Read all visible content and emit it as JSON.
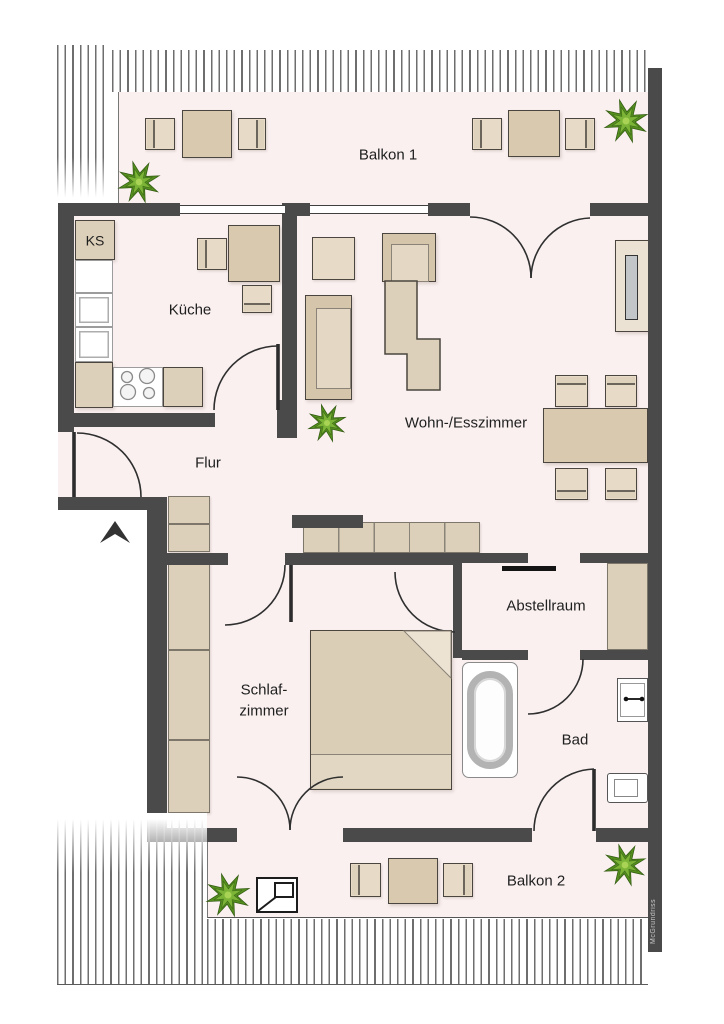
{
  "meta": {
    "type": "apartment-floor-plan"
  },
  "rooms": {
    "balkon1": {
      "label": "Balkon 1"
    },
    "kueche": {
      "label": "Küche"
    },
    "wohnesszimmer": {
      "label": "Wohn-/Esszimmer"
    },
    "flur": {
      "label": "Flur"
    },
    "schlafzimmer": {
      "line1": "Schlaf-",
      "line2": "zimmer"
    },
    "abstellraum": {
      "label": "Abstellraum"
    },
    "bad": {
      "label": "Bad"
    },
    "balkon2": {
      "label": "Balkon 2"
    }
  },
  "annotations": {
    "fridge_label": "KS",
    "watermark": "McGrundriss"
  },
  "icons": [
    "plant-icon",
    "north-arrow-icon",
    "roof-window-icon",
    "bathtub-icon",
    "washbasin-icon",
    "toilet-icon",
    "stove-icon",
    "door-swing-arc"
  ],
  "colors": {
    "wall": "#4a4a4a",
    "floor": "#faf0f0",
    "furniture": "#ddd0ba",
    "furniture_light": "#e7dbc7",
    "furniture_dark": "#d9c9ae",
    "outline": "#4a453e",
    "plant_green": "#7cb437",
    "hatch": "#6e6e6e",
    "text": "#1f1f1f"
  }
}
